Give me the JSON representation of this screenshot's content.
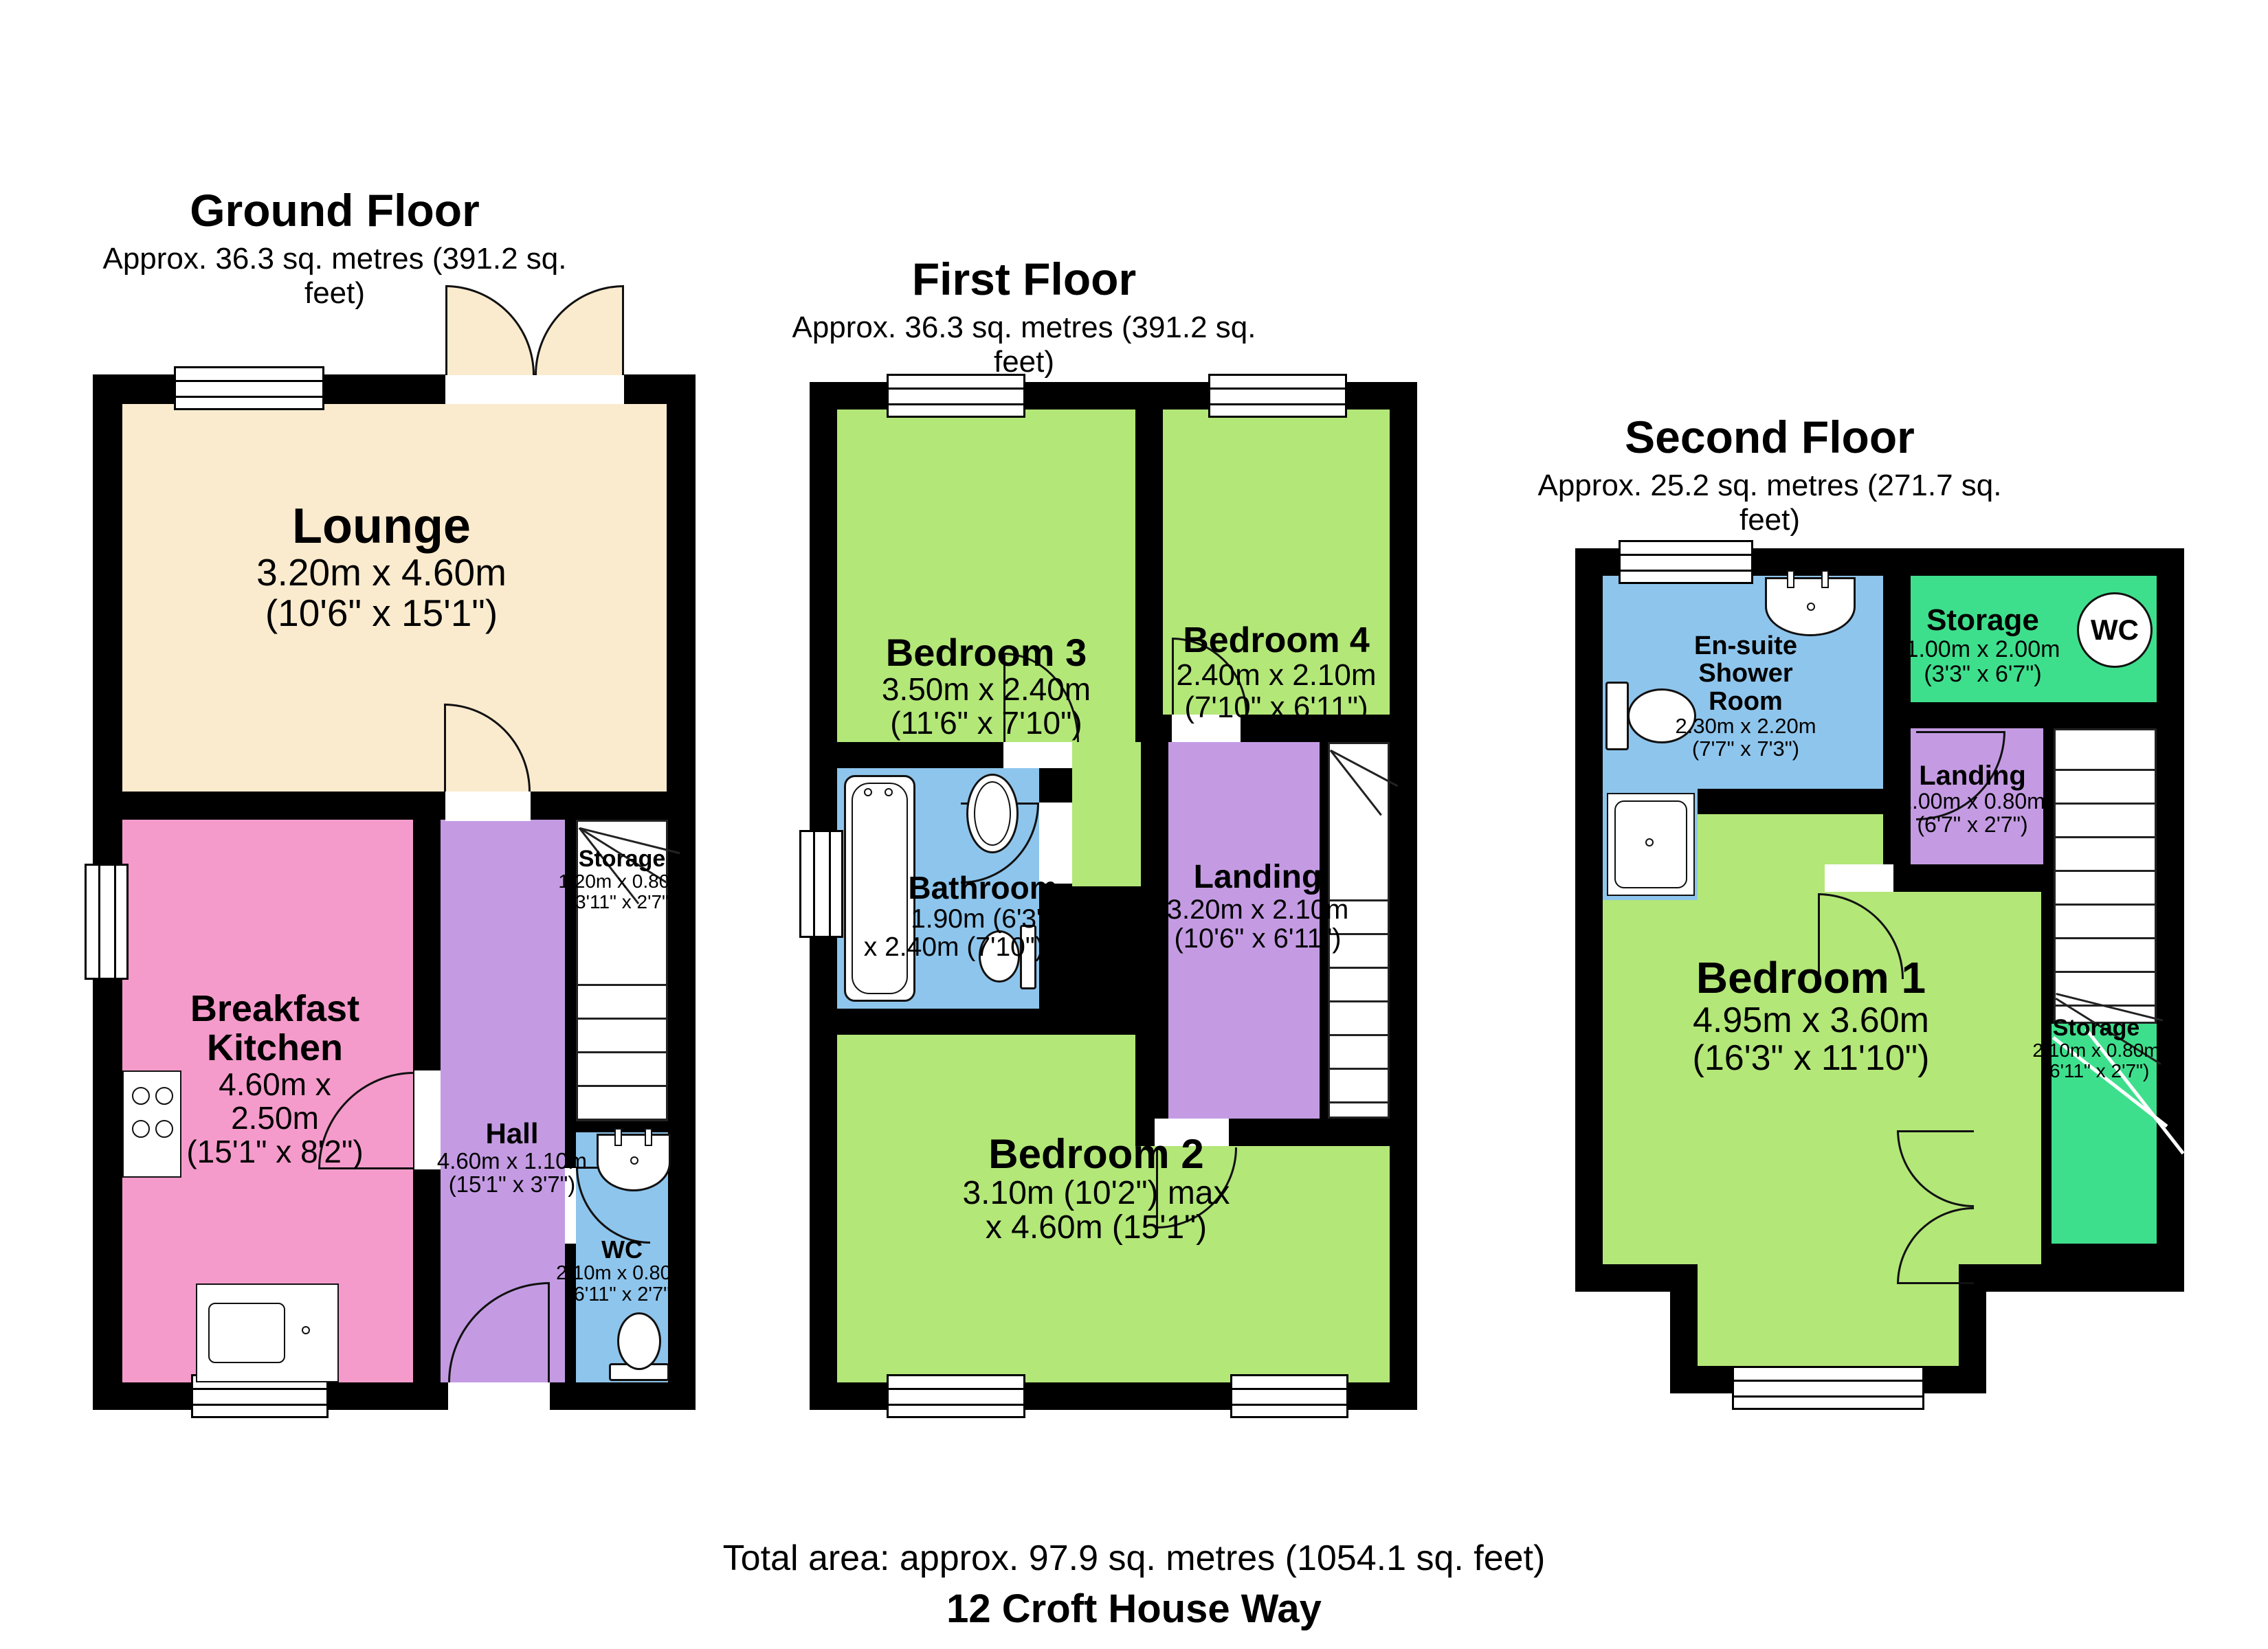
{
  "floors": [
    {
      "title": "Ground Floor",
      "subtitle": "Approx. 36.3 sq. metres (391.2 sq. feet)",
      "rooms": [
        {
          "name": "Lounge",
          "lines": [
            "3.20m x 4.60m",
            "(10'6\" x 15'1\")"
          ]
        },
        {
          "name": "Breakfast Kitchen",
          "lines": [
            "4.60m x 2.50m",
            "(15'1\" x 8'2\")"
          ]
        },
        {
          "name": "Hall",
          "lines": [
            "4.60m x 1.10m",
            "(15'1\" x 3'7\")"
          ]
        },
        {
          "name": "Storage",
          "lines": [
            "1.20m x 0.80m",
            "(3'11\" x 2'7\")"
          ]
        },
        {
          "name": "WC",
          "lines": [
            "2.10m x 0.80m",
            "(6'11\" x 2'7\")"
          ]
        }
      ]
    },
    {
      "title": "First Floor",
      "subtitle": "Approx. 36.3 sq. metres (391.2 sq. feet)",
      "rooms": [
        {
          "name": "Bedroom 3",
          "lines": [
            "3.50m x 2.40m",
            "(11'6\" x 7'10\")"
          ]
        },
        {
          "name": "Bedroom 4",
          "lines": [
            "2.40m x 2.10m",
            "(7'10\" x 6'11\")"
          ]
        },
        {
          "name": "Bathroom",
          "lines": [
            "1.90m (6'3\")",
            "x 2.40m (7'10\") max"
          ]
        },
        {
          "name": "Landing",
          "lines": [
            "3.20m x 2.10m",
            "(10'6\" x 6'11\")"
          ]
        },
        {
          "name": "Bedroom 2",
          "lines": [
            "3.10m (10'2\") max",
            "x 4.60m (15'1\")"
          ]
        }
      ]
    },
    {
      "title": "Second Floor",
      "subtitle": "Approx. 25.2 sq. metres (271.7 sq. feet)",
      "rooms": [
        {
          "name": "En-suite Shower Room",
          "lines": [
            "2.30m x 2.20m",
            "(7'7\" x 7'3\")"
          ]
        },
        {
          "name": "Storage",
          "lines": [
            "1.00m x 2.00m",
            "(3'3\" x 6'7\")"
          ]
        },
        {
          "name": "WC",
          "lines": []
        },
        {
          "name": "Landing",
          "lines": [
            "2.00m x 0.80m",
            "(6'7\" x 2'7\")"
          ]
        },
        {
          "name": "Bedroom 1",
          "lines": [
            "4.95m x 3.60m",
            "(16'3\" x 11'10\")"
          ]
        },
        {
          "name": "Storage",
          "lines": [
            "2.10m x 0.80m",
            "(6'11\" x 2'7\")"
          ]
        }
      ]
    }
  ],
  "footer": {
    "total": "Total area: approx. 97.9 sq. metres (1054.1 sq. feet)",
    "address": "12 Croft House Way"
  },
  "colors": {
    "lounge": "#FBEBCE",
    "kitchen": "#F49BCB",
    "hall_landing": "#C49BE3",
    "bathroom_wc": "#8EC5EC",
    "bedroom": "#B3E778",
    "storage_green": "#3EDF8C",
    "walls": "#000000"
  }
}
